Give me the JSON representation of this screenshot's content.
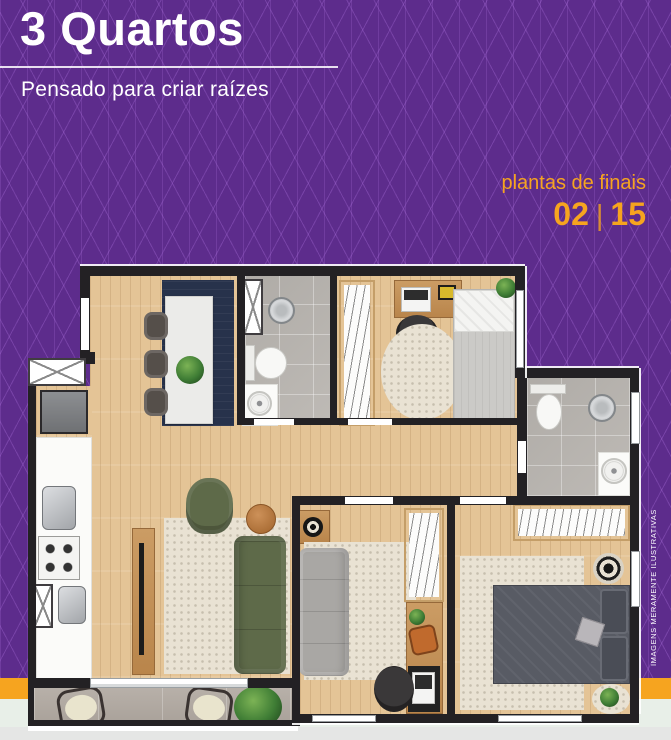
{
  "header": {
    "title": "3 Quartos",
    "subtitle": "Pensado para criar raízes"
  },
  "plan_info": {
    "label": "plantas de finais",
    "first_unit": "02",
    "separator": "|",
    "second_unit": "15"
  },
  "disclaimer": "IMAGENS MERAMENTE ILUSTRATIVAS",
  "colors": {
    "purple": "#5d2c8c",
    "pattern_line": "#9a63d2",
    "orange": "#f6a41f",
    "text_white": "#ffffff",
    "wall": "#232124",
    "wood": "#e4c496",
    "wood_furniture": "#c0905a",
    "tile": "#bab6b1",
    "stone": "#b3aba3",
    "rug_navy": "#27324b",
    "rug_cream": "#e9e2d3",
    "sofa_green": "#5e6a49",
    "sofa_gray": "#a9a7a4",
    "bed_dark": "#585b64",
    "mint": "#e8efe8",
    "footer_gray": "#e5e6e5"
  }
}
